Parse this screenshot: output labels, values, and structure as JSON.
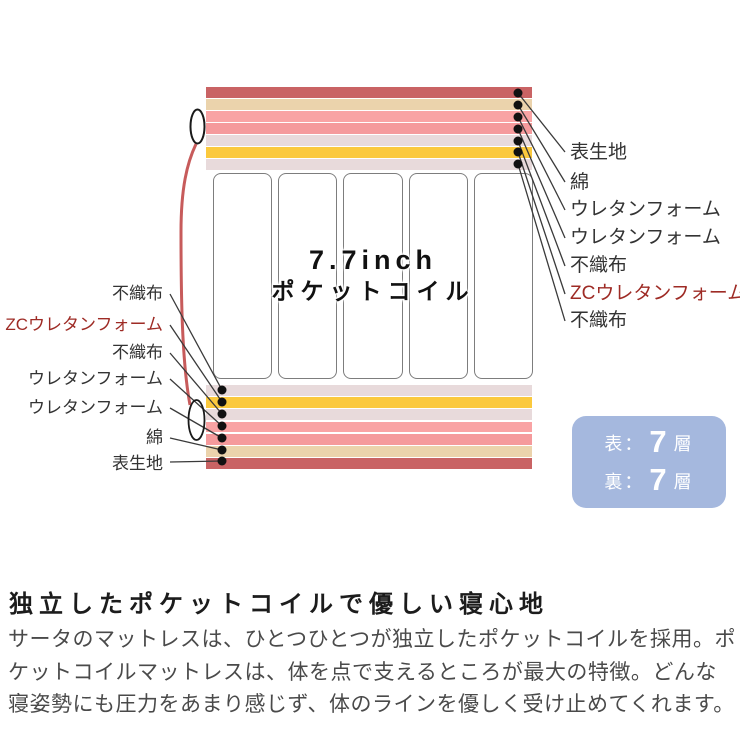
{
  "mattress": {
    "coil_text": {
      "line1": "7.7inch",
      "line2": "ポケットコイル"
    },
    "top_layers": [
      {
        "name": "表生地",
        "color": "#c96364"
      },
      {
        "name": "綿",
        "color": "#ebd3ac"
      },
      {
        "name": "ウレタンフォーム",
        "color": "#f9a3a4"
      },
      {
        "name": "ウレタンフォーム",
        "color": "#f59a9c"
      },
      {
        "name": "不織布",
        "color": "#e8dadb"
      },
      {
        "name": "ZCウレタンフォーム",
        "color": "#fbc93d"
      },
      {
        "name": "不織布",
        "color": "#e8dadb"
      }
    ],
    "bottom_layers": [
      {
        "name": "不織布",
        "color": "#e8dadb"
      },
      {
        "name": "ZCウレタンフォーム",
        "color": "#fbc93d"
      },
      {
        "name": "不織布",
        "color": "#e8dadb"
      },
      {
        "name": "ウレタンフォーム",
        "color": "#f9a3a4"
      },
      {
        "name": "ウレタンフォーム",
        "color": "#f59a9c"
      },
      {
        "name": "綿",
        "color": "#ebd3ac"
      },
      {
        "name": "表生地",
        "color": "#c96364"
      }
    ],
    "right_labels": [
      {
        "text": "表生地",
        "color": "#333333"
      },
      {
        "text": "綿",
        "color": "#333333"
      },
      {
        "text": "ウレタンフォーム",
        "color": "#333333"
      },
      {
        "text": "ウレタンフォーム",
        "color": "#333333"
      },
      {
        "text": "不織布",
        "color": "#333333"
      },
      {
        "text": "ZCウレタンフォーム",
        "color": "#9e2b25"
      },
      {
        "text": "不織布",
        "color": "#333333"
      }
    ],
    "left_labels": [
      {
        "text": "不織布",
        "color": "#333333"
      },
      {
        "text": "ZCウレタンフォーム",
        "color": "#9e2b25"
      },
      {
        "text": "不織布",
        "color": "#333333"
      },
      {
        "text": "ウレタンフォーム",
        "color": "#333333"
      },
      {
        "text": "ウレタンフォーム",
        "color": "#333333"
      },
      {
        "text": "綿",
        "color": "#333333"
      },
      {
        "text": "表生地",
        "color": "#333333"
      }
    ],
    "accent_colors": {
      "thread_red": "#c75b5b",
      "connector": "#3a3a3a",
      "coil_border": "#7d7d7d"
    }
  },
  "badge": {
    "bg_color": "#a5b8de",
    "rows": [
      {
        "label": "表：",
        "value": "7",
        "unit": "層"
      },
      {
        "label": "裏：",
        "value": "7",
        "unit": "層"
      }
    ]
  },
  "section": {
    "heading": "独立したポケットコイルで優しい寝心地",
    "body": "サータのマットレスは、ひとつひとつが独立したポケットコイルを採用。ポケットコイルマットレスは、体を点で支えるところが最大の特徴。どんな寝姿勢にも圧力をあまり感じず、体のラインを優しく受け止めてくれます。"
  }
}
